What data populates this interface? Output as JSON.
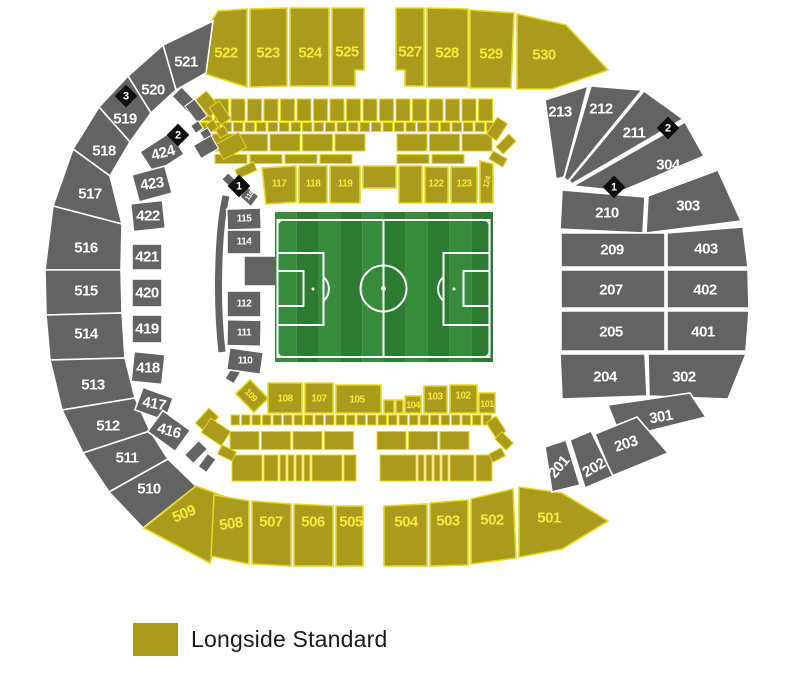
{
  "legend": {
    "label": "Longside Standard"
  },
  "colors": {
    "longside_standard": "#ab9b1d",
    "longside_divider": "#e8d620",
    "longside_label": "#f9e73e",
    "unavailable": "#636363",
    "unavailable_divider": "#ffffff",
    "unavailable_label": "#ffffff",
    "marker_bg": "#0d0d0d",
    "marker_label": "#ffffff",
    "pitch_green_light": "#388a3c",
    "pitch_green_dark": "#2d7a32",
    "pitch_line": "#ffffff"
  },
  "markers": [
    {
      "label": "3"
    },
    {
      "label": "2"
    },
    {
      "label": "1"
    },
    {
      "label": "2"
    },
    {
      "label": "1"
    }
  ],
  "sections": [
    {
      "id": "522",
      "label": "522",
      "category": "longside-standard"
    },
    {
      "id": "523",
      "label": "523",
      "category": "longside-standard"
    },
    {
      "id": "524",
      "label": "524",
      "category": "longside-standard"
    },
    {
      "id": "525",
      "label": "525",
      "category": "longside-standard"
    },
    {
      "id": "527",
      "label": "527",
      "category": "longside-standard"
    },
    {
      "id": "528",
      "label": "528",
      "category": "longside-standard"
    },
    {
      "id": "529",
      "label": "529",
      "category": "longside-standard"
    },
    {
      "id": "530",
      "label": "530",
      "category": "longside-standard"
    },
    {
      "id": "521",
      "label": "521",
      "category": "unavailable"
    },
    {
      "id": "520",
      "label": "520",
      "category": "unavailable"
    },
    {
      "id": "519",
      "label": "519",
      "category": "unavailable"
    },
    {
      "id": "518",
      "label": "518",
      "category": "unavailable"
    },
    {
      "id": "517",
      "label": "517",
      "category": "unavailable"
    },
    {
      "id": "516",
      "label": "516",
      "category": "unavailable"
    },
    {
      "id": "515",
      "label": "515",
      "category": "unavailable"
    },
    {
      "id": "514",
      "label": "514",
      "category": "unavailable"
    },
    {
      "id": "513",
      "label": "513",
      "category": "unavailable"
    },
    {
      "id": "512",
      "label": "512",
      "category": "unavailable"
    },
    {
      "id": "511",
      "label": "511",
      "category": "unavailable"
    },
    {
      "id": "510",
      "label": "510",
      "category": "unavailable"
    },
    {
      "id": "509",
      "label": "509",
      "category": "longside-standard"
    },
    {
      "id": "508",
      "label": "508",
      "category": "longside-standard"
    },
    {
      "id": "507",
      "label": "507",
      "category": "longside-standard"
    },
    {
      "id": "506",
      "label": "506",
      "category": "longside-standard"
    },
    {
      "id": "505",
      "label": "505",
      "category": "longside-standard"
    },
    {
      "id": "504",
      "label": "504",
      "category": "longside-standard"
    },
    {
      "id": "503",
      "label": "503",
      "category": "longside-standard"
    },
    {
      "id": "502",
      "label": "502",
      "category": "longside-standard"
    },
    {
      "id": "501",
      "label": "501",
      "category": "longside-standard"
    },
    {
      "id": "424",
      "label": "424",
      "category": "unavailable"
    },
    {
      "id": "423",
      "label": "423",
      "category": "unavailable"
    },
    {
      "id": "422",
      "label": "422",
      "category": "unavailable"
    },
    {
      "id": "421",
      "label": "421",
      "category": "unavailable"
    },
    {
      "id": "420",
      "label": "420",
      "category": "unavailable"
    },
    {
      "id": "419",
      "label": "419",
      "category": "unavailable"
    },
    {
      "id": "418",
      "label": "418",
      "category": "unavailable"
    },
    {
      "id": "417",
      "label": "417",
      "category": "unavailable"
    },
    {
      "id": "416",
      "label": "416",
      "category": "unavailable"
    },
    {
      "id": "116",
      "label": "116",
      "category": "unavailable"
    },
    {
      "id": "115",
      "label": "115",
      "category": "unavailable"
    },
    {
      "id": "114",
      "label": "114",
      "category": "unavailable"
    },
    {
      "id": "112",
      "label": "112",
      "category": "unavailable"
    },
    {
      "id": "111",
      "label": "111",
      "category": "unavailable"
    },
    {
      "id": "110",
      "label": "110",
      "category": "unavailable"
    },
    {
      "id": "117",
      "label": "117",
      "category": "longside-standard"
    },
    {
      "id": "118",
      "label": "118",
      "category": "longside-standard"
    },
    {
      "id": "119",
      "label": "119",
      "category": "longside-standard"
    },
    {
      "id": "122",
      "label": "122",
      "category": "longside-standard"
    },
    {
      "id": "123",
      "label": "123",
      "category": "longside-standard"
    },
    {
      "id": "124",
      "label": "124",
      "category": "longside-standard"
    },
    {
      "id": "109",
      "label": "109",
      "category": "longside-standard"
    },
    {
      "id": "108",
      "label": "108",
      "category": "longside-standard"
    },
    {
      "id": "107",
      "label": "107",
      "category": "longside-standard"
    },
    {
      "id": "105",
      "label": "105",
      "category": "longside-standard"
    },
    {
      "id": "104",
      "label": "104",
      "category": "longside-standard"
    },
    {
      "id": "103",
      "label": "103",
      "category": "longside-standard"
    },
    {
      "id": "102",
      "label": "102",
      "category": "longside-standard"
    },
    {
      "id": "101",
      "label": "101",
      "category": "longside-standard"
    },
    {
      "id": "213",
      "label": "213",
      "category": "unavailable"
    },
    {
      "id": "212",
      "label": "212",
      "category": "unavailable"
    },
    {
      "id": "211",
      "label": "211",
      "category": "unavailable"
    },
    {
      "id": "304",
      "label": "304",
      "category": "unavailable"
    },
    {
      "id": "210",
      "label": "210",
      "category": "unavailable"
    },
    {
      "id": "303",
      "label": "303",
      "category": "unavailable"
    },
    {
      "id": "209",
      "label": "209",
      "category": "unavailable"
    },
    {
      "id": "403",
      "label": "403",
      "category": "unavailable"
    },
    {
      "id": "207",
      "label": "207",
      "category": "unavailable"
    },
    {
      "id": "402",
      "label": "402",
      "category": "unavailable"
    },
    {
      "id": "205",
      "label": "205",
      "category": "unavailable"
    },
    {
      "id": "401",
      "label": "401",
      "category": "unavailable"
    },
    {
      "id": "204",
      "label": "204",
      "category": "unavailable"
    },
    {
      "id": "302",
      "label": "302",
      "category": "unavailable"
    },
    {
      "id": "301",
      "label": "301",
      "category": "unavailable"
    },
    {
      "id": "203",
      "label": "203",
      "category": "unavailable"
    },
    {
      "id": "202",
      "label": "202",
      "category": "unavailable"
    },
    {
      "id": "201",
      "label": "201",
      "category": "unavailable"
    }
  ]
}
